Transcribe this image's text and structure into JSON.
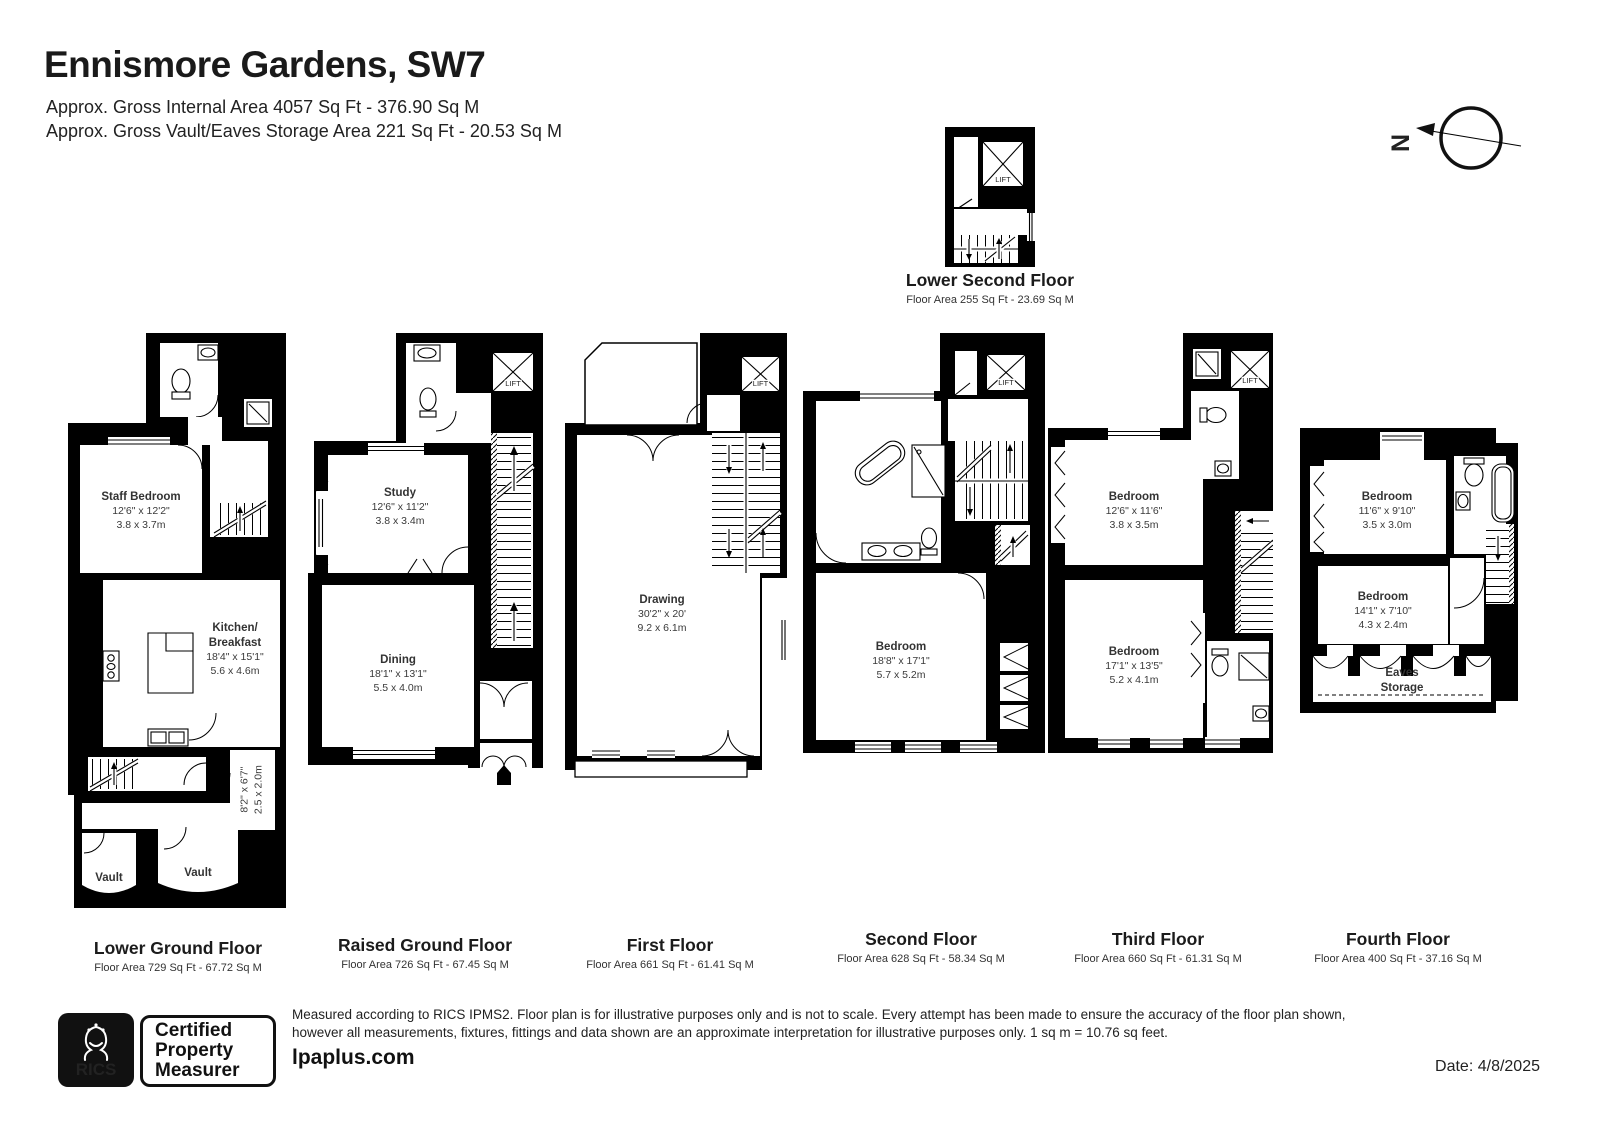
{
  "header": {
    "title": "Ennismore Gardens, SW7",
    "subtitle1": "Approx. Gross Internal Area 4057 Sq Ft - 376.90 Sq M",
    "subtitle2": "Approx. Gross Vault/Eaves Storage Area 221 Sq Ft - 20.53 Sq M"
  },
  "compass": {
    "label": "N"
  },
  "lift_label": "LIFT",
  "floors": {
    "lower_second": {
      "name": "Lower Second Floor",
      "area": "Floor Area 255 Sq Ft - 23.69 Sq M"
    },
    "lower_ground": {
      "name": "Lower Ground Floor",
      "area": "Floor Area 729 Sq Ft - 67.72 Sq M",
      "staff_bedroom": {
        "name": "Staff Bedroom",
        "ft": "12'6\" x 12'2\"",
        "m": "3.8 x 3.7m"
      },
      "kitchen": {
        "name1": "Kitchen/",
        "name2": "Breakfast",
        "ft": "18'4\" x 15'1\"",
        "m": "5.6 x 4.6m"
      },
      "lobby": {
        "ft": "8'2\" x 6'7\"",
        "m": "2.5 x 2.0m"
      },
      "vault_left": "Vault",
      "vault_right": "Vault"
    },
    "raised_ground": {
      "name": "Raised Ground Floor",
      "area": "Floor Area 726 Sq Ft - 67.45 Sq M",
      "study": {
        "name": "Study",
        "ft": "12'6\" x 11'2\"",
        "m": "3.8 x 3.4m"
      },
      "dining": {
        "name": "Dining",
        "ft": "18'1\" x 13'1\"",
        "m": "5.5 x 4.0m"
      }
    },
    "first": {
      "name": "First Floor",
      "area": "Floor Area 661 Sq Ft - 61.41 Sq M",
      "drawing": {
        "name": "Drawing",
        "ft": "30'2\" x 20'",
        "m": "9.2 x 6.1m"
      }
    },
    "second": {
      "name": "Second Floor",
      "area": "Floor Area 628 Sq Ft - 58.34 Sq M",
      "bedroom": {
        "name": "Bedroom",
        "ft": "18'8\" x 17'1\"",
        "m": "5.7 x 5.2m"
      }
    },
    "third": {
      "name": "Third Floor",
      "area": "Floor Area 660 Sq Ft - 61.31 Sq M",
      "bedroom1": {
        "name": "Bedroom",
        "ft": "12'6\" x 11'6\"",
        "m": "3.8 x 3.5m"
      },
      "bedroom2": {
        "name": "Bedroom",
        "ft": "17'1\" x 13'5\"",
        "m": "5.2 x 4.1m"
      }
    },
    "fourth": {
      "name": "Fourth Floor",
      "area": "Floor Area 400 Sq Ft - 37.16 Sq M",
      "bedroom1": {
        "name": "Bedroom",
        "ft": "11'6\" x 9'10\"",
        "m": "3.5 x 3.0m"
      },
      "bedroom2": {
        "name": "Bedroom",
        "ft": "14'1\" x 7'10\"",
        "m": "4.3 x 2.4m"
      },
      "eaves": {
        "name1": "Eaves",
        "name2": "Storage"
      }
    }
  },
  "footer": {
    "rics": "RICS",
    "badge_line1": "Certified",
    "badge_line2": "Property",
    "badge_line3": "Measurer",
    "disclaimer1": "Measured according to RICS IPMS2. Floor plan is for illustrative purposes only and is not to scale. Every attempt has been made to ensure the accuracy of the floor plan shown,",
    "disclaimer2": "however all measurements, fixtures, fittings and data shown are an approximate interpretation for illustrative purposes only. 1 sq m = 10.76 sq feet.",
    "brand": "lpaplus.com",
    "date": "Date: 4/8/2025"
  }
}
